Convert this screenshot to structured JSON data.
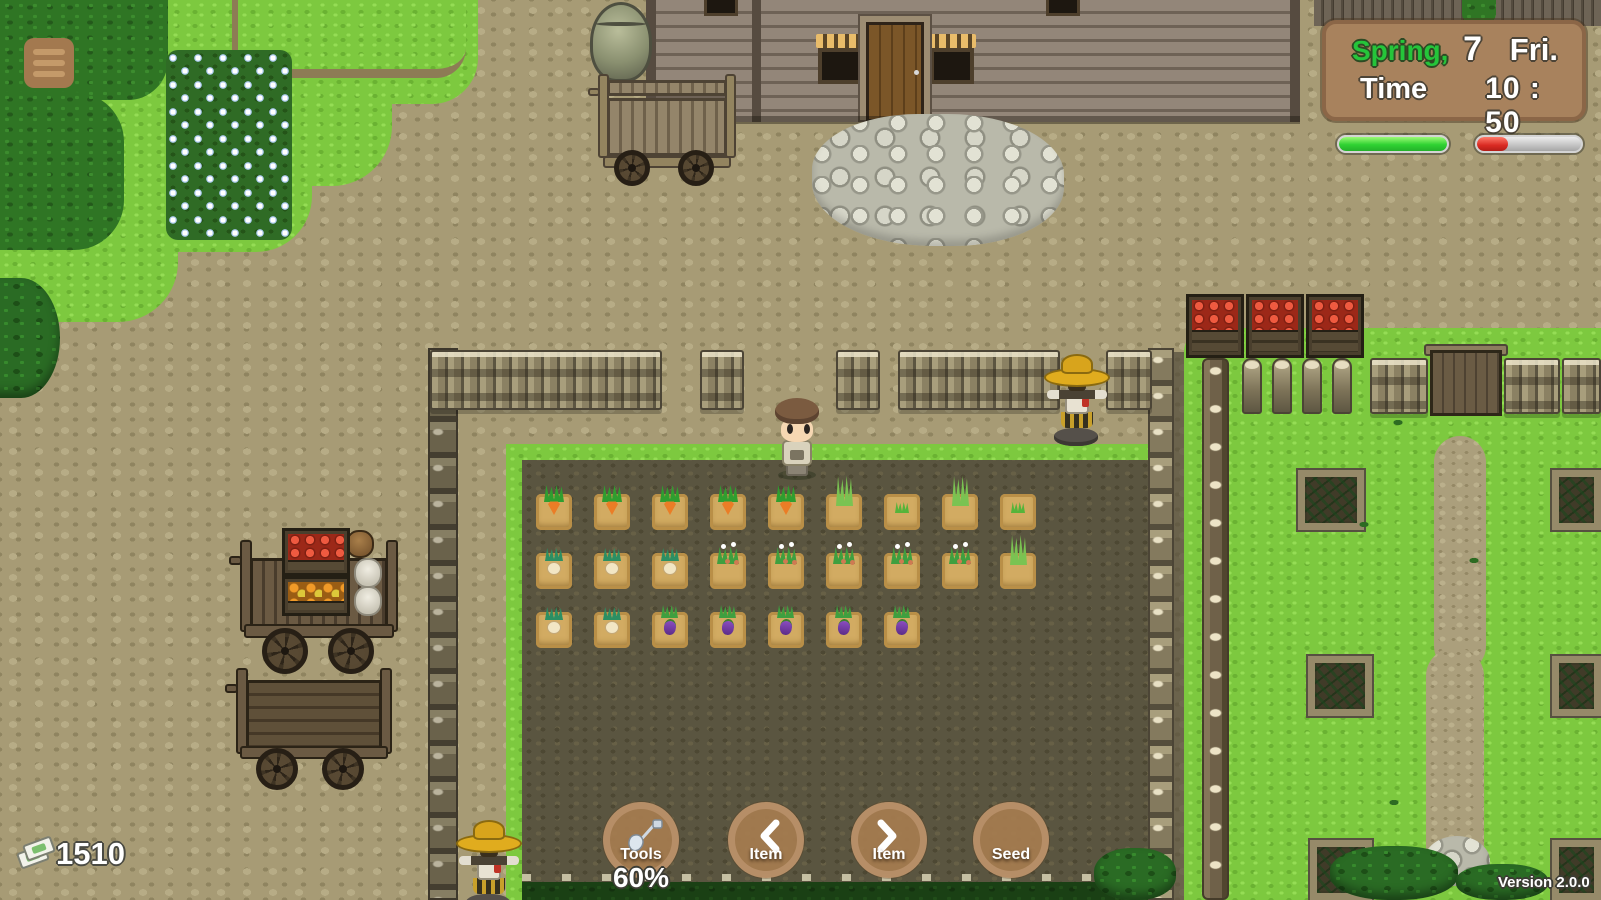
{
  "hud": {
    "menu": {
      "icon": "hamburger-icon"
    },
    "calendar": {
      "season": "Spring,",
      "day": "7",
      "weekday": "Fri.",
      "time_label": "Time",
      "time_value": "10 : 50",
      "season_color": "#25c53a",
      "panel_color": "#a8825d"
    },
    "bars": {
      "green": {
        "percent": 100,
        "color": "#2fd232"
      },
      "red": {
        "percent": 30,
        "color": "#d92a22"
      }
    },
    "money": {
      "amount": "1510",
      "icon": "money-icon"
    },
    "buttons": [
      {
        "label": "Tools",
        "icon": "shovel-icon"
      },
      {
        "label": "Item",
        "icon": "chevron-left-icon"
      },
      {
        "label": "Item",
        "icon": "chevron-right-icon"
      },
      {
        "label": "Seed",
        "icon": "none"
      }
    ],
    "tool_charge": "60%",
    "version": "Version 2.0.0"
  },
  "world": {
    "field_crops": {
      "tile": 36,
      "x_start": 536,
      "x_step": 58,
      "rows": [
        {
          "y": 494,
          "types": [
            "carrot",
            "carrot",
            "carrot",
            "carrot",
            "carrot",
            "tall",
            "sprout",
            "tall",
            "sprout"
          ]
        },
        {
          "y": 553,
          "types": [
            "turnip",
            "turnip",
            "turnip",
            "berry",
            "berry",
            "berry",
            "berry",
            "berry",
            "tall"
          ]
        },
        {
          "y": 612,
          "types": [
            "turnip",
            "turnip",
            "eggplant",
            "eggplant",
            "eggplant",
            "eggplant",
            "eggplant"
          ]
        }
      ]
    }
  }
}
